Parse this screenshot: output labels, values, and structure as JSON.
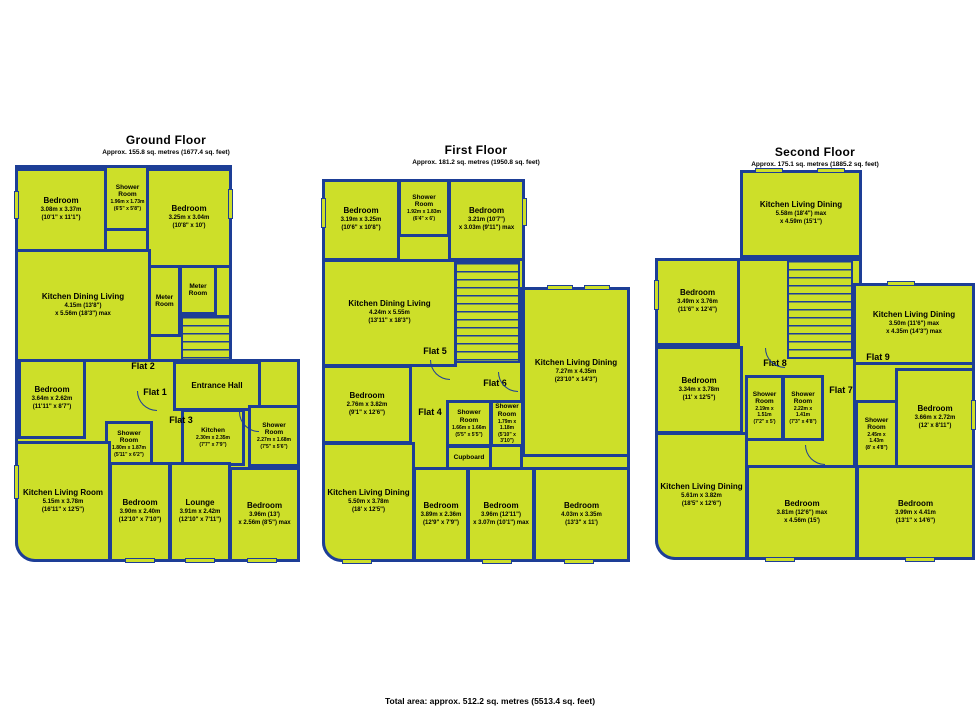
{
  "colors": {
    "fill": "#cddf29",
    "wall": "#1d3e96",
    "background": "#ffffff",
    "text": "#000000"
  },
  "footer": "Total area: approx. 512.2 sq. metres (5513.4 sq. feet)",
  "floors": {
    "ground": {
      "title": "Ground Floor",
      "subtitle": "Approx. 155.8 sq. metres (1677.4 sq. feet)",
      "flats": {
        "f1": "Flat 1",
        "f2": "Flat 2",
        "f3": "Flat 3"
      },
      "rooms": {
        "b1": {
          "name": "Bedroom",
          "d1": "3.08m x 3.37m",
          "d2": "(10'1\" x 11'1\")"
        },
        "sh1": {
          "name": "Shower Room",
          "d1": "1.96m x 1.73m",
          "d2": "(6'5\" x 5'8\")"
        },
        "b2": {
          "name": "Bedroom",
          "d1": "3.25m x 3.04m",
          "d2": "(10'8\" x 10')"
        },
        "kdl": {
          "name": "Kitchen Dining Living",
          "d1": "4.15m (13'8\")",
          "d2": "x 5.56m (18'3\") max"
        },
        "m1": {
          "name": "Meter Room"
        },
        "m2": {
          "name": "Meter Room"
        },
        "b3": {
          "name": "Bedroom",
          "d1": "3.64m x 2.62m",
          "d2": "(11'11\" x 8'7\")"
        },
        "hall": {
          "name": "Entrance Hall"
        },
        "sh2": {
          "name": "Shower Room",
          "d1": "1.80m x 1.87m",
          "d2": "(5'11\" x 6'2\")"
        },
        "kit": {
          "name": "Kitchen",
          "d1": "2.30m x 2.35m",
          "d2": "(7'7\" x 7'9\")"
        },
        "sh3": {
          "name": "Shower Room",
          "d1": "2.27m x 1.68m",
          "d2": "(7'5\" x 5'6\")"
        },
        "klr": {
          "name": "Kitchen Living Room",
          "d1": "5.15m x 3.78m",
          "d2": "(16'11\" x 12'5\")"
        },
        "b4": {
          "name": "Bedroom",
          "d1": "3.90m x 2.40m",
          "d2": "(12'10\" x 7'10\")"
        },
        "lounge": {
          "name": "Lounge",
          "d1": "3.91m x 2.42m",
          "d2": "(12'10\" x 7'11\")"
        },
        "b5": {
          "name": "Bedroom",
          "d1": "3.96m (13')",
          "d2": "x 2.56m (8'5\") max"
        }
      }
    },
    "first": {
      "title": "First Floor",
      "subtitle": "Approx. 181.2 sq. metres (1950.8 sq. feet)",
      "flats": {
        "f4": "Flat 4",
        "f5": "Flat 5",
        "f6": "Flat 6"
      },
      "rooms": {
        "b1": {
          "name": "Bedroom",
          "d1": "3.19m x 3.25m",
          "d2": "(10'6\" x 10'8\")"
        },
        "sh1": {
          "name": "Shower Room",
          "d1": "1.92m x 1.83m",
          "d2": "(6'4\" x 6')"
        },
        "b2": {
          "name": "Bedroom",
          "d1": "3.21m (10'7\")",
          "d2": "x 3.03m (9'11\") max"
        },
        "kdl": {
          "name": "Kitchen Dining Living",
          "d1": "4.24m x 5.55m",
          "d2": "(13'11\" x 18'3\")"
        },
        "kld7": {
          "name": "Kitchen Living Dining",
          "d1": "7.27m x 4.35m",
          "d2": "(23'10\" x 14'3\")"
        },
        "b3": {
          "name": "Bedroom",
          "d1": "2.76m x 3.82m",
          "d2": "(9'1\" x 12'6\")"
        },
        "sh2": {
          "name": "Shower Room",
          "d1": "1.66m x 1.66m",
          "d2": "(5'5\" x 5'5\")"
        },
        "sh3": {
          "name": "Shower Room",
          "d1": "1.79m x 1.18m",
          "d2": "(5'10\" x 3'10\")"
        },
        "cup": {
          "name": "Cupboard"
        },
        "kld5": {
          "name": "Kitchen Living Dining",
          "d1": "5.50m x 3.78m",
          "d2": "(18' x 12'5\")"
        },
        "b4": {
          "name": "Bedroom",
          "d1": "3.89m x 2.36m",
          "d2": "(12'9\" x 7'9\")"
        },
        "b5": {
          "name": "Bedroom",
          "d1": "3.96m (12'11\")",
          "d2": "x 3.07m (10'1\") max"
        },
        "b6": {
          "name": "Bedroom",
          "d1": "4.03m x 3.35m",
          "d2": "(13'3\" x 11')"
        }
      }
    },
    "second": {
      "title": "Second Floor",
      "subtitle": "Approx. 175.1 sq. metres (1885.2 sq. feet)",
      "flats": {
        "f7": "Flat 7",
        "f8": "Flat 8",
        "f9": "Flat 9"
      },
      "rooms": {
        "kld558": {
          "name": "Kitchen Living Dining",
          "d1": "5.58m (18'4\") max",
          "d2": "x 4.59m (15'1\")"
        },
        "b1": {
          "name": "Bedroom",
          "d1": "3.49m x 3.76m",
          "d2": "(11'6\" x 12'4\")"
        },
        "kld350": {
          "name": "Kitchen Living Dining",
          "d1": "3.50m (11'6\") max",
          "d2": "x 4.35m (14'3\") max"
        },
        "b2": {
          "name": "Bedroom",
          "d1": "3.34m x 3.78m",
          "d2": "(11' x 12'5\")"
        },
        "sh1": {
          "name": "Shower Room",
          "d1": "2.19m x 1.51m",
          "d2": "(7'2\" x 5')"
        },
        "sh2": {
          "name": "Shower Room",
          "d1": "2.22m x 1.41m",
          "d2": "(7'3\" x 4'8\")"
        },
        "sh3": {
          "name": "Shower Room",
          "d1": "2.45m x 1.43m",
          "d2": "(8' x 4'8\")"
        },
        "b3": {
          "name": "Bedroom",
          "d1": "3.66m x 2.72m",
          "d2": "(12' x 8'11\")"
        },
        "kld561": {
          "name": "Kitchen Living Dining",
          "d1": "5.61m x 3.82m",
          "d2": "(18'5\" x 12'6\")"
        },
        "b4": {
          "name": "Bedroom",
          "d1": "3.81m (12'6\") max",
          "d2": "x 4.56m (15')"
        },
        "b5": {
          "name": "Bedroom",
          "d1": "3.99m x 4.41m",
          "d2": "(13'1\" x 14'6\")"
        }
      }
    }
  }
}
